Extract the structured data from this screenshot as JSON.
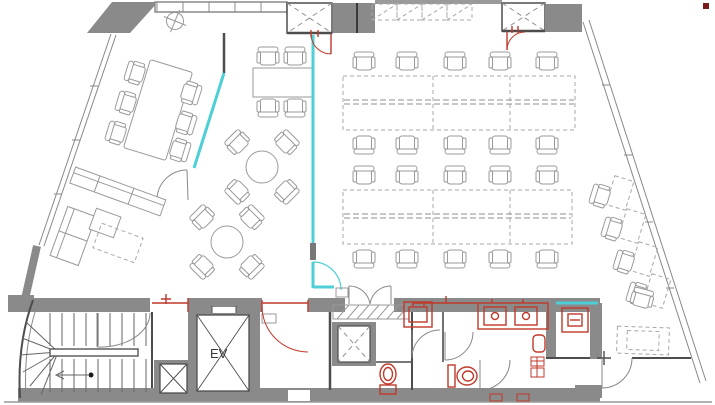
{
  "title": "Office floor plan",
  "labels": {
    "elevator": "EV"
  },
  "colors": {
    "background": "#ffffff",
    "wall_gray": "#8a8a8a",
    "line_dark": "#4d4d4d",
    "furniture_gray": "#9a9a9a",
    "accent_teal": "#4ecfd6",
    "fixture_red": "#c0392b",
    "marker_dark_red": "#7a1a1a"
  }
}
